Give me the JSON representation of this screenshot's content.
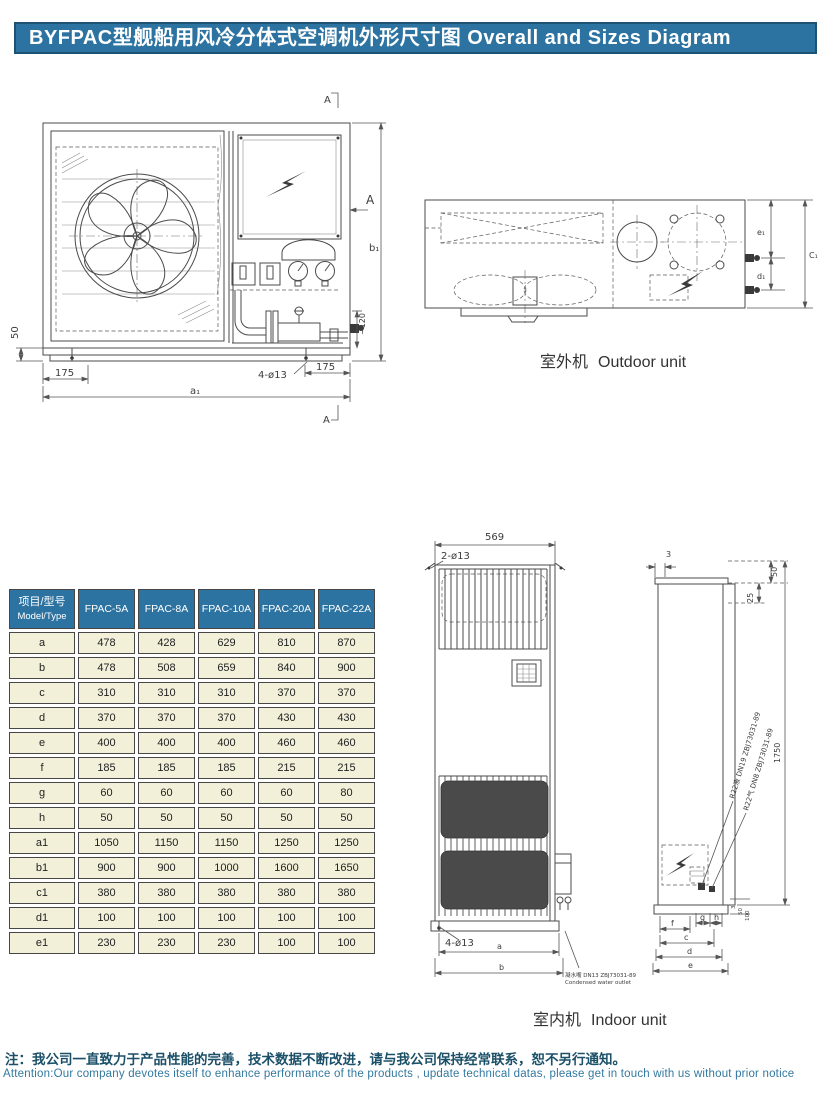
{
  "header": {
    "title": "BYFPAC型舰船用风冷分体式空调机外形尺寸图 Overall and Sizes Diagram"
  },
  "outdoor": {
    "caption_cn": "室外机",
    "caption_en": "Outdoor unit",
    "front": {
      "dim_base_h": "50",
      "dim_left_foot": "175",
      "holes": "4-ø13",
      "dim_right_foot": "175",
      "dim_width": "a₁",
      "dim_height": "b₁",
      "dim_clearance": "~120",
      "section_mark": "A"
    },
    "top": {
      "dim_e1": "e₁",
      "dim_d1": "d₁",
      "dim_c1": "C₁"
    }
  },
  "indoor": {
    "caption_cn": "室内机",
    "caption_en": "Indoor unit",
    "front": {
      "dim_width": "569",
      "holes_top": "2-ø13",
      "holes_bottom": "4-ø13",
      "dim_a": "a",
      "dim_b": "b",
      "outlet_cn": "凝水嘴 DN13 ZBJ73031-89",
      "outlet_en": "Condensed water outlet"
    },
    "side": {
      "dim_panel": "3",
      "dim_top50": "50",
      "dim_top25": "25",
      "dim_height": "1750",
      "pipe_liquid": "R22液 DN19 ZBJ73031-89",
      "pipe_gas": "R22气 DN8 ZBJ73031-89",
      "dim_f": "f",
      "dim_g": "g",
      "dim_h": "h",
      "dim_c": "c",
      "dim_d": "d",
      "dim_e": "e",
      "dim_b3": "3",
      "dim_b50": "50",
      "dim_b100": "100"
    }
  },
  "table": {
    "header": [
      "项目/型号",
      "FPAC-5A",
      "FPAC-8A",
      "FPAC-10A",
      "FPAC-20A",
      "FPAC-22A"
    ],
    "header_sub": "Model/Type",
    "rows": [
      {
        "label": "a",
        "values": [
          478,
          428,
          629,
          810,
          870
        ]
      },
      {
        "label": "b",
        "values": [
          478,
          508,
          659,
          840,
          900
        ]
      },
      {
        "label": "c",
        "values": [
          310,
          310,
          310,
          370,
          370
        ]
      },
      {
        "label": "d",
        "values": [
          370,
          370,
          370,
          430,
          430
        ]
      },
      {
        "label": "e",
        "values": [
          400,
          400,
          400,
          460,
          460
        ]
      },
      {
        "label": "f",
        "values": [
          185,
          185,
          185,
          215,
          215
        ]
      },
      {
        "label": "g",
        "values": [
          60,
          60,
          60,
          60,
          80
        ]
      },
      {
        "label": "h",
        "values": [
          50,
          50,
          50,
          50,
          50
        ]
      },
      {
        "label": "a1",
        "values": [
          1050,
          1150,
          1150,
          1250,
          1250
        ]
      },
      {
        "label": "b1",
        "values": [
          900,
          900,
          1000,
          1600,
          1650
        ]
      },
      {
        "label": "c1",
        "values": [
          380,
          380,
          380,
          380,
          380
        ]
      },
      {
        "label": "d1",
        "values": [
          100,
          100,
          100,
          100,
          100
        ]
      },
      {
        "label": "e1",
        "values": [
          230,
          230,
          230,
          100,
          100
        ]
      }
    ]
  },
  "notes": {
    "cn": "注：我公司一直致力于产品性能的完善，技术数据不断改进，请与我公司保持经常联系，恕不另行通知。",
    "en": "Attention:Our company devotes itself to enhance performance of the products , update technical datas, please get in touch with us without prior notice"
  },
  "colors": {
    "banner_bg": "#2d73a1",
    "banner_border": "#1d5273",
    "cell_bg": "#f3f0da",
    "note_cn": "#1b5068",
    "note_en": "#3279a0"
  }
}
